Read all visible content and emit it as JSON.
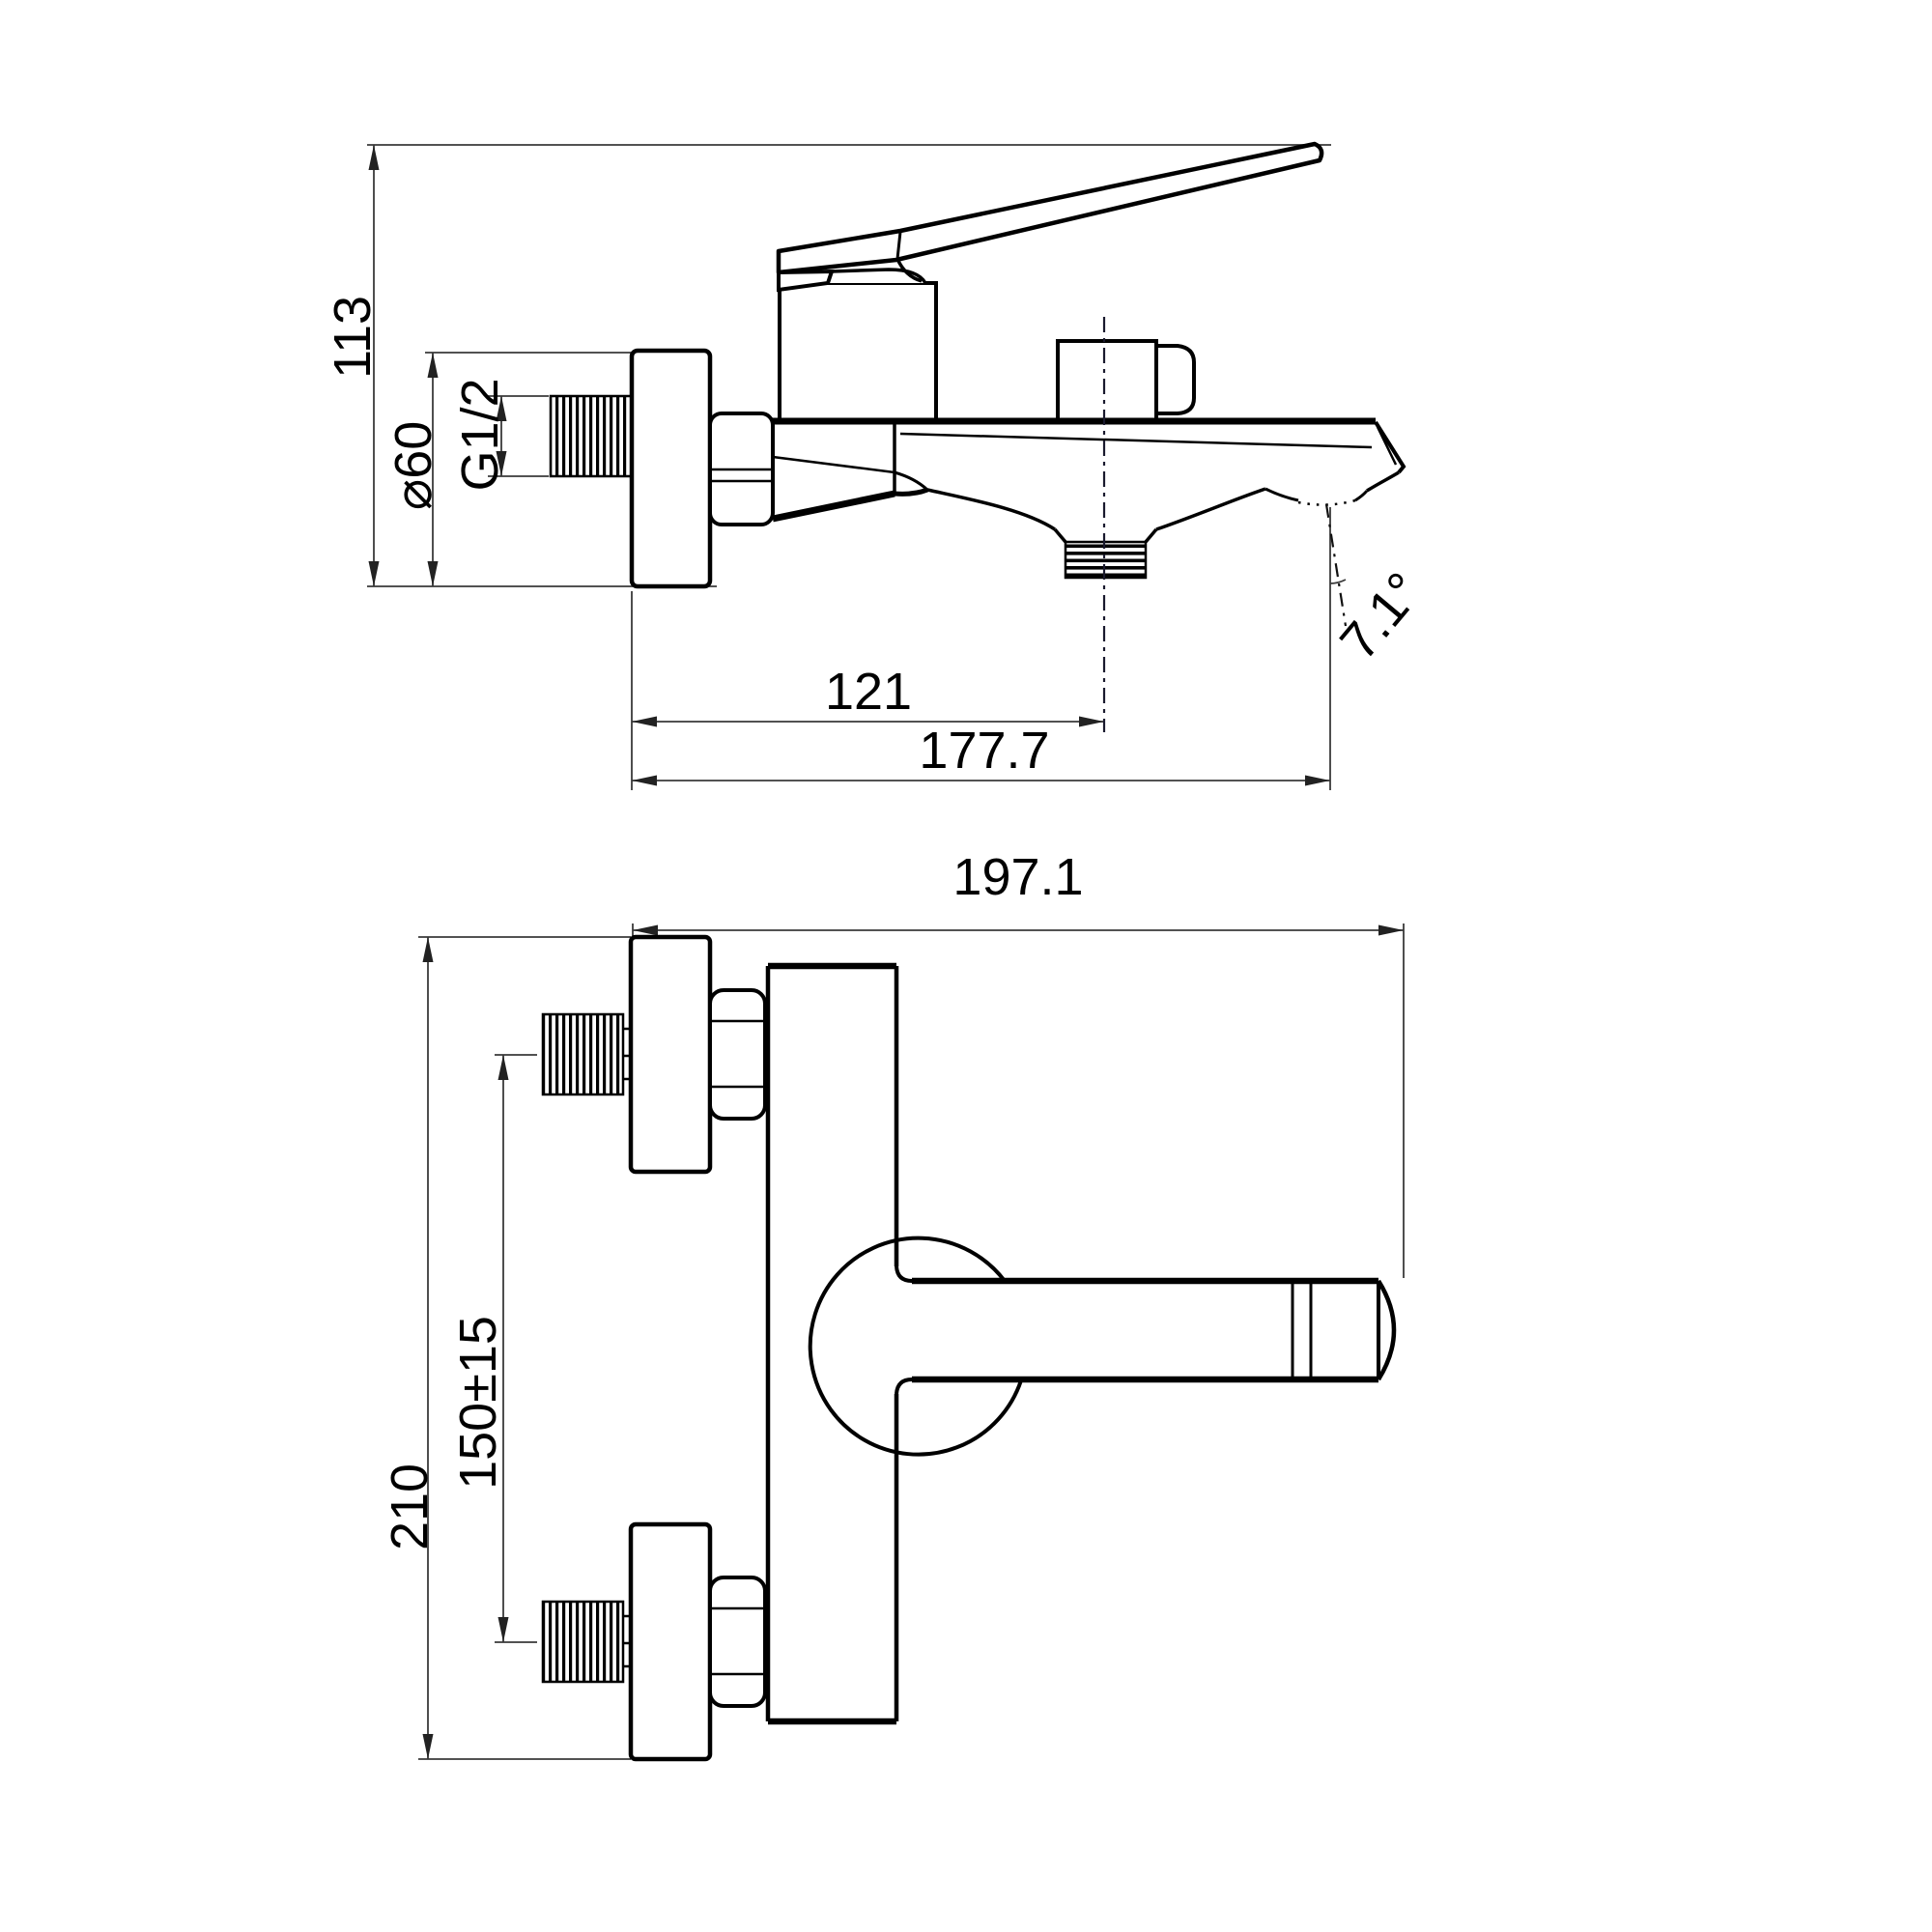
{
  "drawing": {
    "title": "bath-shower-mixer-technical-drawing",
    "background_color": "#ffffff",
    "line_color": "#000000",
    "dimension_color": "#3a3a3a",
    "side_view": {
      "overall_height_label": "113",
      "escutcheon_diameter_label": "⌀60",
      "inlet_thread_label": "G1/2",
      "shower_outlet_offset_label": "121",
      "spout_reach_label": "177.7",
      "spout_angle_label": "7.1°"
    },
    "plan_view": {
      "overall_reach_label": "197.1",
      "overall_height_label": "210",
      "inlet_spacing_label": "150±15"
    }
  }
}
